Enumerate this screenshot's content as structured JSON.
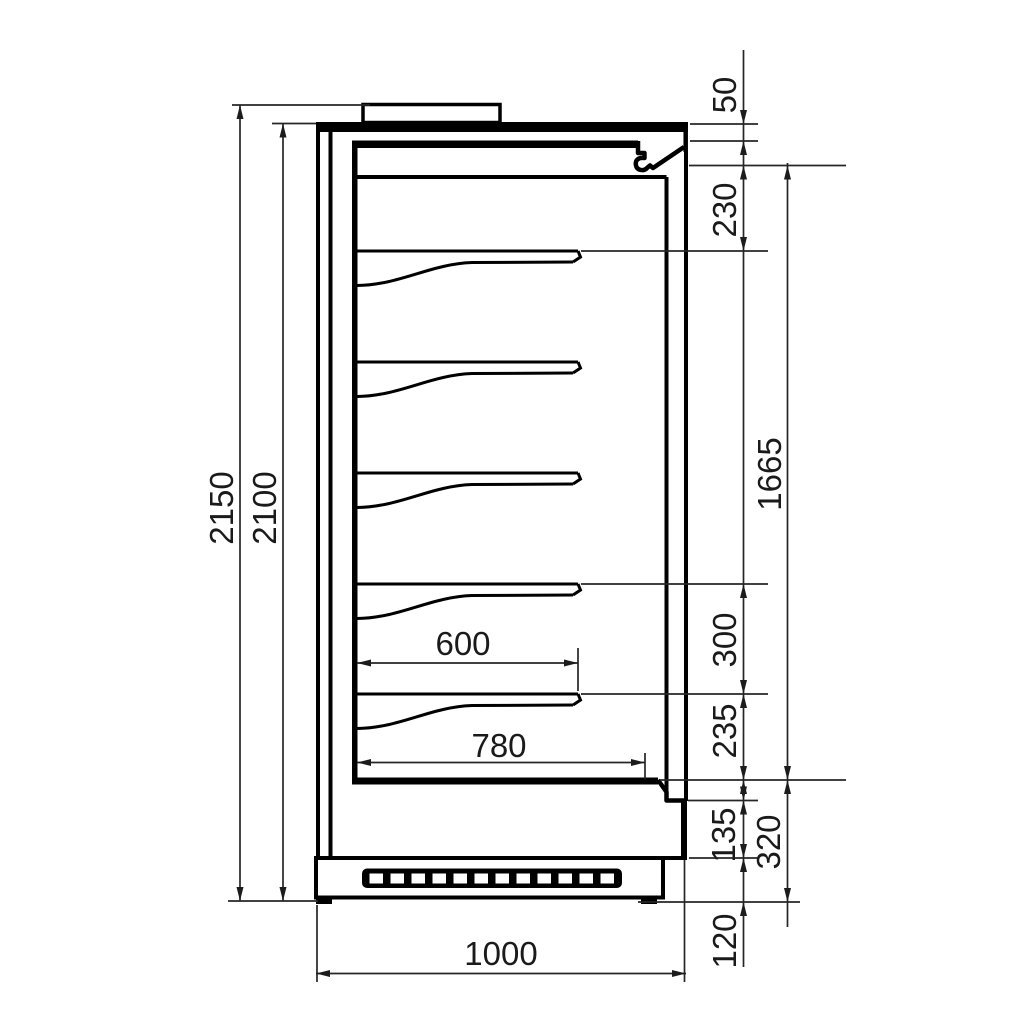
{
  "drawing": {
    "background": "#ffffff",
    "outline_color": "#000000",
    "dimension_line_color": "#262626",
    "shelf_count": 5
  },
  "dimensions": {
    "overall_height": "2150",
    "body_height": "2100",
    "top_panel_thickness": "50",
    "canopy_to_first_shelf": "230",
    "display_opening_height": "1665",
    "shelf_spacing": "300",
    "last_shelf_to_deck": "235",
    "lower_step_height": "135",
    "base_section_height": "320",
    "plinth_height": "120",
    "shelf_depth": "600",
    "deck_depth": "780",
    "overall_depth": "1000"
  }
}
